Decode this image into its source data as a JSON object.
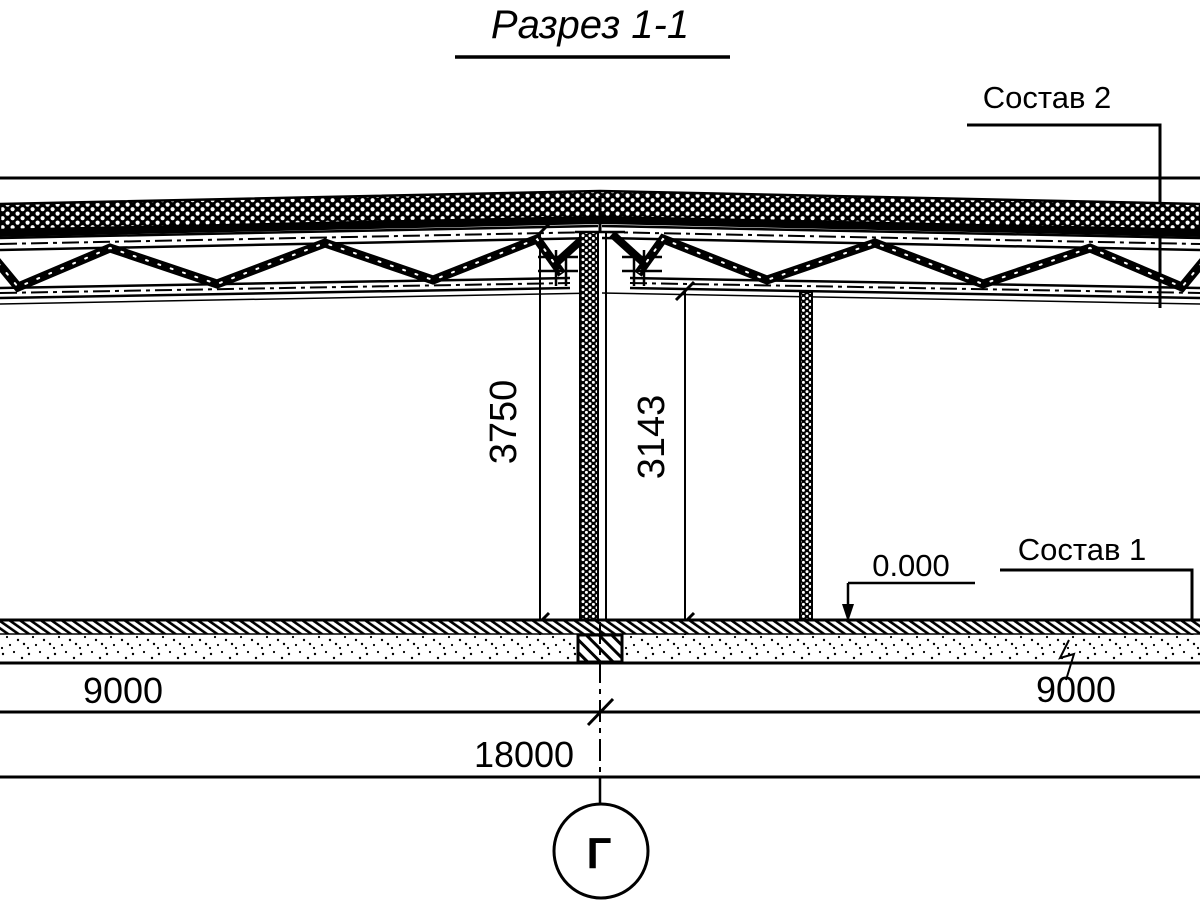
{
  "drawing": {
    "title": "Разрез 1-1",
    "callouts": {
      "composition_2": "Состав 2",
      "composition_1": "Состав 1",
      "elevation_zero": "0.000"
    },
    "dimensions": {
      "height_to_roof_top": "3750",
      "height_to_truss_bottom": "3143",
      "span_left": "9000",
      "span_right": "9000",
      "span_total": "18000"
    },
    "axis": {
      "label": "Г"
    },
    "colors": {
      "ink": "#000000",
      "paper": "#ffffff"
    }
  }
}
